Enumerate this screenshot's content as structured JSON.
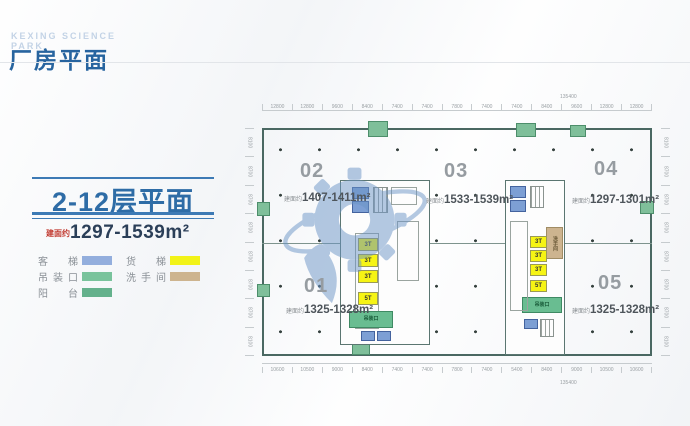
{
  "header": {
    "en_line1": "KEXING SCIENCE",
    "en_line2": "PARK",
    "title": "厂房平面"
  },
  "panel": {
    "floor_title": "2-12层平面",
    "area_prefix": "建面约",
    "area_range": "1297-1539m²",
    "legend": [
      {
        "label": "客梯",
        "color": "#93aedd"
      },
      {
        "label": "货梯",
        "color": "#f2f318"
      },
      {
        "label": "吊装口",
        "color": "#79c39c"
      },
      {
        "label": "洗手间",
        "color": "#cdb48f"
      },
      {
        "label": "阳台",
        "color": "#64b18c"
      }
    ]
  },
  "plan": {
    "units": [
      {
        "no": "01",
        "area_prefix": "建面约",
        "area": "1325-1328m²"
      },
      {
        "no": "02",
        "area_prefix": "建面约",
        "area": "1407-1411m²"
      },
      {
        "no": "03",
        "area_prefix": "建面约",
        "area": "1533-1539m²"
      },
      {
        "no": "04",
        "area_prefix": "建面约",
        "area": "1297-1301m²"
      },
      {
        "no": "05",
        "area_prefix": "建面约",
        "area": "1325-1328m²"
      }
    ],
    "freight_left": [
      "3T",
      "3T",
      "3T",
      "5T"
    ],
    "freight_right": [
      "3T",
      "3T",
      "3T",
      "5T"
    ],
    "hoist_label": "吊装口",
    "washroom_label": "洗手间",
    "top_dims": [
      "12800",
      "12800",
      "9600",
      "8400",
      "7400",
      "7400",
      "7800",
      "7400",
      "7400",
      "8400",
      "9600",
      "12800",
      "12800"
    ],
    "top_total": "135400",
    "bottom_dims": [
      "10600",
      "10500",
      "9000",
      "8400",
      "7400",
      "7400",
      "7800",
      "7400",
      "5400",
      "8400",
      "9000",
      "10500",
      "10600"
    ],
    "bottom_total": "135400",
    "left_dims": [
      "8100",
      "8700",
      "8700",
      "8700",
      "8700",
      "8700",
      "8700",
      "8100"
    ],
    "right_dims": [
      "8100",
      "8700",
      "8700",
      "8700",
      "8700",
      "8700",
      "8700",
      "8100"
    ],
    "colors": {
      "passenger_elevator": "#7d9fd4",
      "freight_elevator": "#f6f414",
      "hoist_opening": "#69bd91",
      "washroom": "#cdb48f",
      "balcony": "#7fbf9a"
    }
  }
}
